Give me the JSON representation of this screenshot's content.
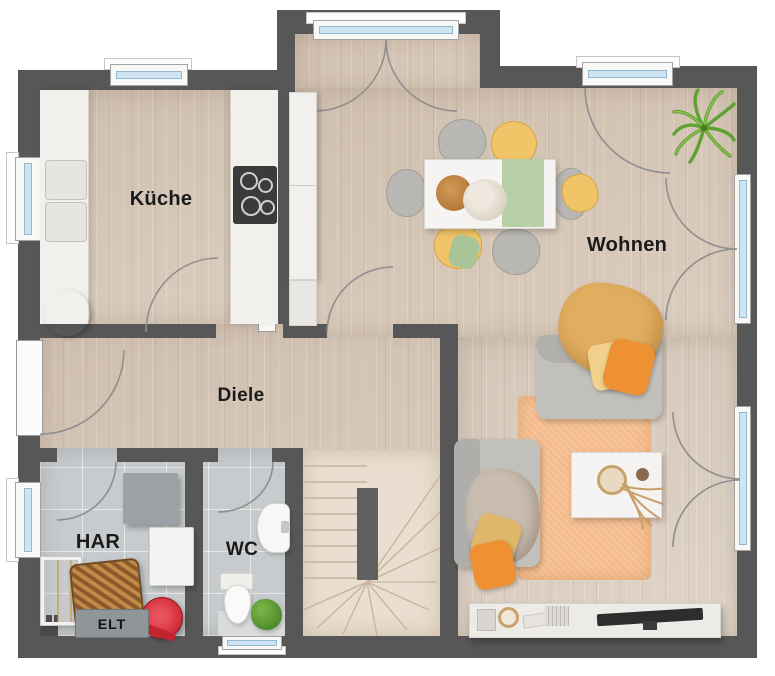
{
  "floorplan": {
    "rooms": {
      "kitchen": {
        "label": "Küche",
        "floor": "wood"
      },
      "living": {
        "label": "Wohnen",
        "floor": "wood"
      },
      "hallway": {
        "label": "Diele",
        "floor": "wood"
      },
      "utility": {
        "label": "HAR",
        "floor": "tile"
      },
      "wc": {
        "label": "WC",
        "floor": "tile"
      }
    },
    "fixtures": {
      "electrical_panel_label": "ELT"
    },
    "colors": {
      "background": "#ffffff",
      "wall": "#575757",
      "wood_floor": "#d9cabb",
      "wood_floor_light": "#ded2c5",
      "tile_floor": "#c7cbcd",
      "stair_floor": "#e9decf",
      "window_glass": "#cfe4f2",
      "door_arc": "#8f8f8f",
      "rug": "#f4bc8d",
      "sofa_gray": "#c2c0bb",
      "blanket_yellow": "#e1ae60",
      "pillow_orange": "#ee9133",
      "pillow_yellow": "#f2d18c",
      "table_runner_green": "#b6cfa4",
      "chair_gray": "#b9b7b3",
      "chair_yellow": "#f1c468",
      "plant_green": "#64a737",
      "cabinet": "#f2f0ed",
      "cooktop": "#3b3b3b",
      "panel_gray": "#90959a",
      "vacuum_red": "#d6313c",
      "basket_brown": "#b06a2f",
      "text": "#1b1b1b"
    }
  }
}
